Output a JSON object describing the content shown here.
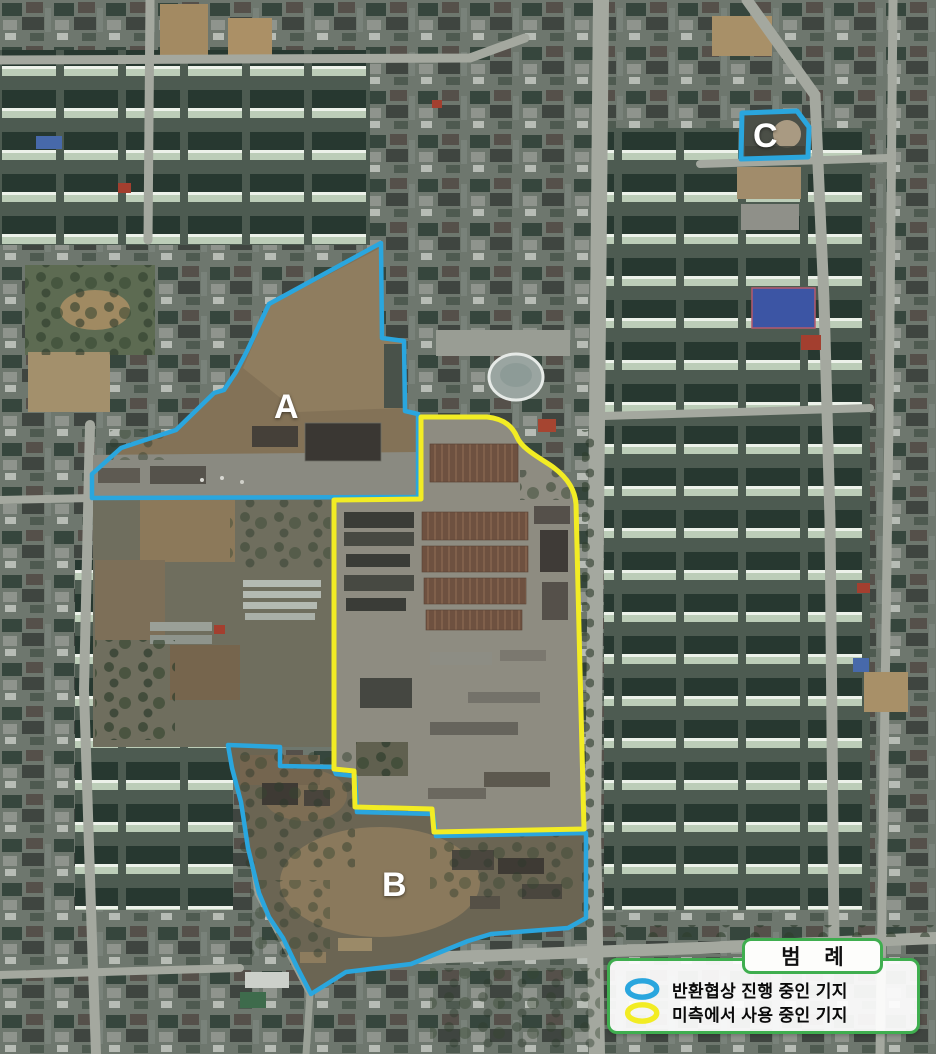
{
  "map": {
    "region_labels": [
      {
        "id": "A",
        "label": "A"
      },
      {
        "id": "B",
        "label": "B"
      },
      {
        "id": "C",
        "label": "C"
      }
    ],
    "regions": [
      {
        "label": "A",
        "outline": "blue",
        "status": "반환협상 진행 중인 기지"
      },
      {
        "label": "B",
        "outline": "blue",
        "status": "반환협상 진행 중인 기지"
      },
      {
        "label": "C",
        "outline": "blue",
        "status": "반환협상 진행 중인 기지"
      },
      {
        "label": "",
        "outline": "yellow",
        "status": "미측에서 사용 중인 기지"
      }
    ]
  },
  "legend": {
    "title": "범 례",
    "items": [
      {
        "symbol": "blue-ellipse-outline",
        "label": "반환협상 진행 중인 기지"
      },
      {
        "symbol": "yellow-ellipse-outline",
        "label": "미측에서 사용 중인 기지"
      }
    ]
  },
  "colors": {
    "return_negotiation_blue": "#2aa6de",
    "us_in_use_yellow": "#f2ec24",
    "legend_border_green": "#3fae4f",
    "label_text": "#ffffff"
  }
}
